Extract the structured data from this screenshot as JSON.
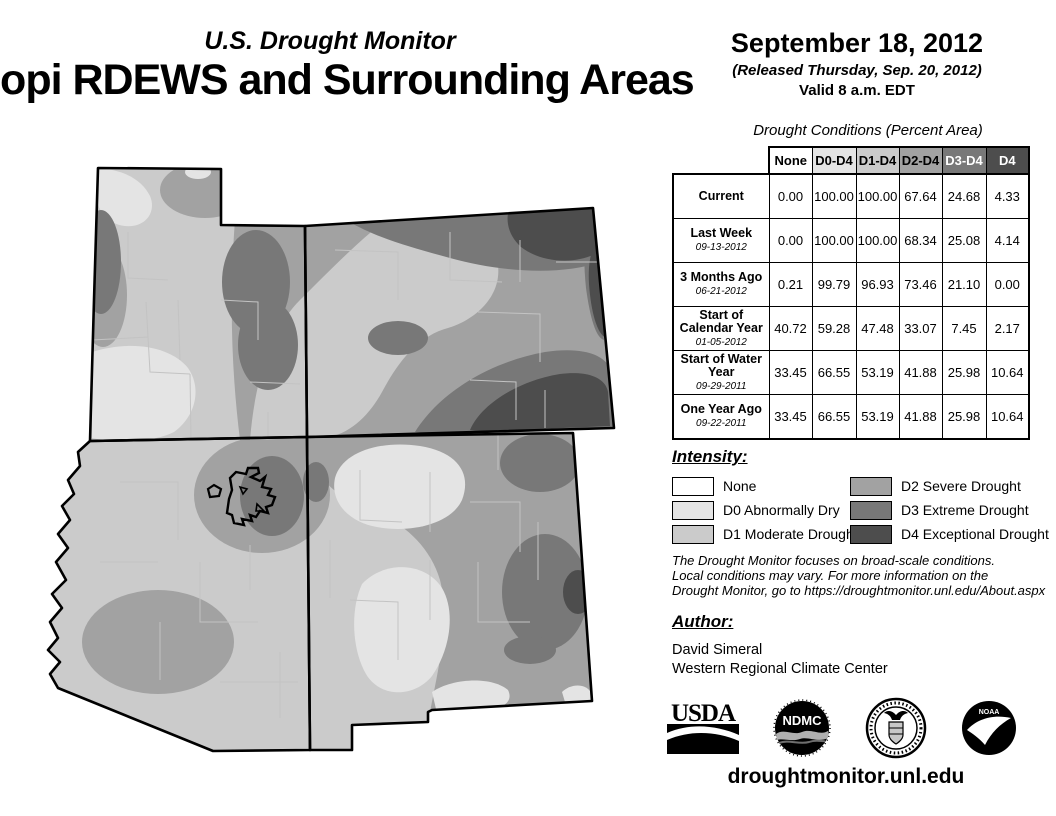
{
  "header": {
    "program": "U.S. Drought Monitor",
    "title": "Hopi RDEWS and Surrounding Areas",
    "date": "September 18, 2012",
    "released": "(Released Thursday, Sep. 20, 2012)",
    "valid": "Valid 8 a.m. EDT"
  },
  "table": {
    "title": "Drought Conditions (Percent Area)",
    "columns": [
      {
        "label": "None",
        "bg": "#ffffff",
        "fg": "#000000"
      },
      {
        "label": "D0-D4",
        "bg": "#e4e4e4",
        "fg": "#000000"
      },
      {
        "label": "D1-D4",
        "bg": "#cbcbcb",
        "fg": "#000000"
      },
      {
        "label": "D2-D4",
        "bg": "#a2a2a2",
        "fg": "#000000"
      },
      {
        "label": "D3-D4",
        "bg": "#787878",
        "fg": "#ffffff"
      },
      {
        "label": "D4",
        "bg": "#4d4d4d",
        "fg": "#ffffff"
      }
    ],
    "rows": [
      {
        "label": "Current",
        "date": "",
        "values": [
          "0.00",
          "100.00",
          "100.00",
          "67.64",
          "24.68",
          "4.33"
        ]
      },
      {
        "label": "Last Week",
        "date": "09-13-2012",
        "values": [
          "0.00",
          "100.00",
          "100.00",
          "68.34",
          "25.08",
          "4.14"
        ]
      },
      {
        "label": "3 Months Ago",
        "date": "06-21-2012",
        "values": [
          "0.21",
          "99.79",
          "96.93",
          "73.46",
          "21.10",
          "0.00"
        ]
      },
      {
        "label": "Start of Calendar Year",
        "date": "01-05-2012",
        "values": [
          "40.72",
          "59.28",
          "47.48",
          "33.07",
          "7.45",
          "2.17"
        ]
      },
      {
        "label": "Start of Water Year",
        "date": "09-29-2011",
        "values": [
          "33.45",
          "66.55",
          "53.19",
          "41.88",
          "25.98",
          "10.64"
        ]
      },
      {
        "label": "One Year Ago",
        "date": "09-22-2011",
        "values": [
          "33.45",
          "66.55",
          "53.19",
          "41.88",
          "25.98",
          "10.64"
        ]
      }
    ]
  },
  "legend": {
    "title": "Intensity:",
    "items": [
      {
        "code": "none",
        "label": "None",
        "color": "#ffffff"
      },
      {
        "code": "d0",
        "label": "D0 Abnormally Dry",
        "color": "#e4e4e4"
      },
      {
        "code": "d1",
        "label": "D1 Moderate Drought",
        "color": "#cbcbcb"
      },
      {
        "code": "d2",
        "label": "D2 Severe Drought",
        "color": "#a2a2a2"
      },
      {
        "code": "d3",
        "label": "D3 Extreme Drought",
        "color": "#787878"
      },
      {
        "code": "d4",
        "label": "D4 Exceptional Drought",
        "color": "#4d4d4d"
      }
    ]
  },
  "disclaimer": {
    "line1": "The Drought Monitor focuses on broad-scale conditions.",
    "line2": "Local conditions may vary. For more information on the",
    "line3": "Drought Monitor, go to https://droughtmonitor.unl.edu/About.aspx"
  },
  "author": {
    "title": "Author:",
    "name": "David Simeral",
    "org": "Western Regional Climate Center"
  },
  "footer": {
    "url": "droughtmonitor.unl.edu",
    "logos": [
      {
        "name": "USDA"
      },
      {
        "name": "NDMC"
      },
      {
        "name": "Department of Commerce"
      },
      {
        "name": "NOAA"
      }
    ]
  }
}
